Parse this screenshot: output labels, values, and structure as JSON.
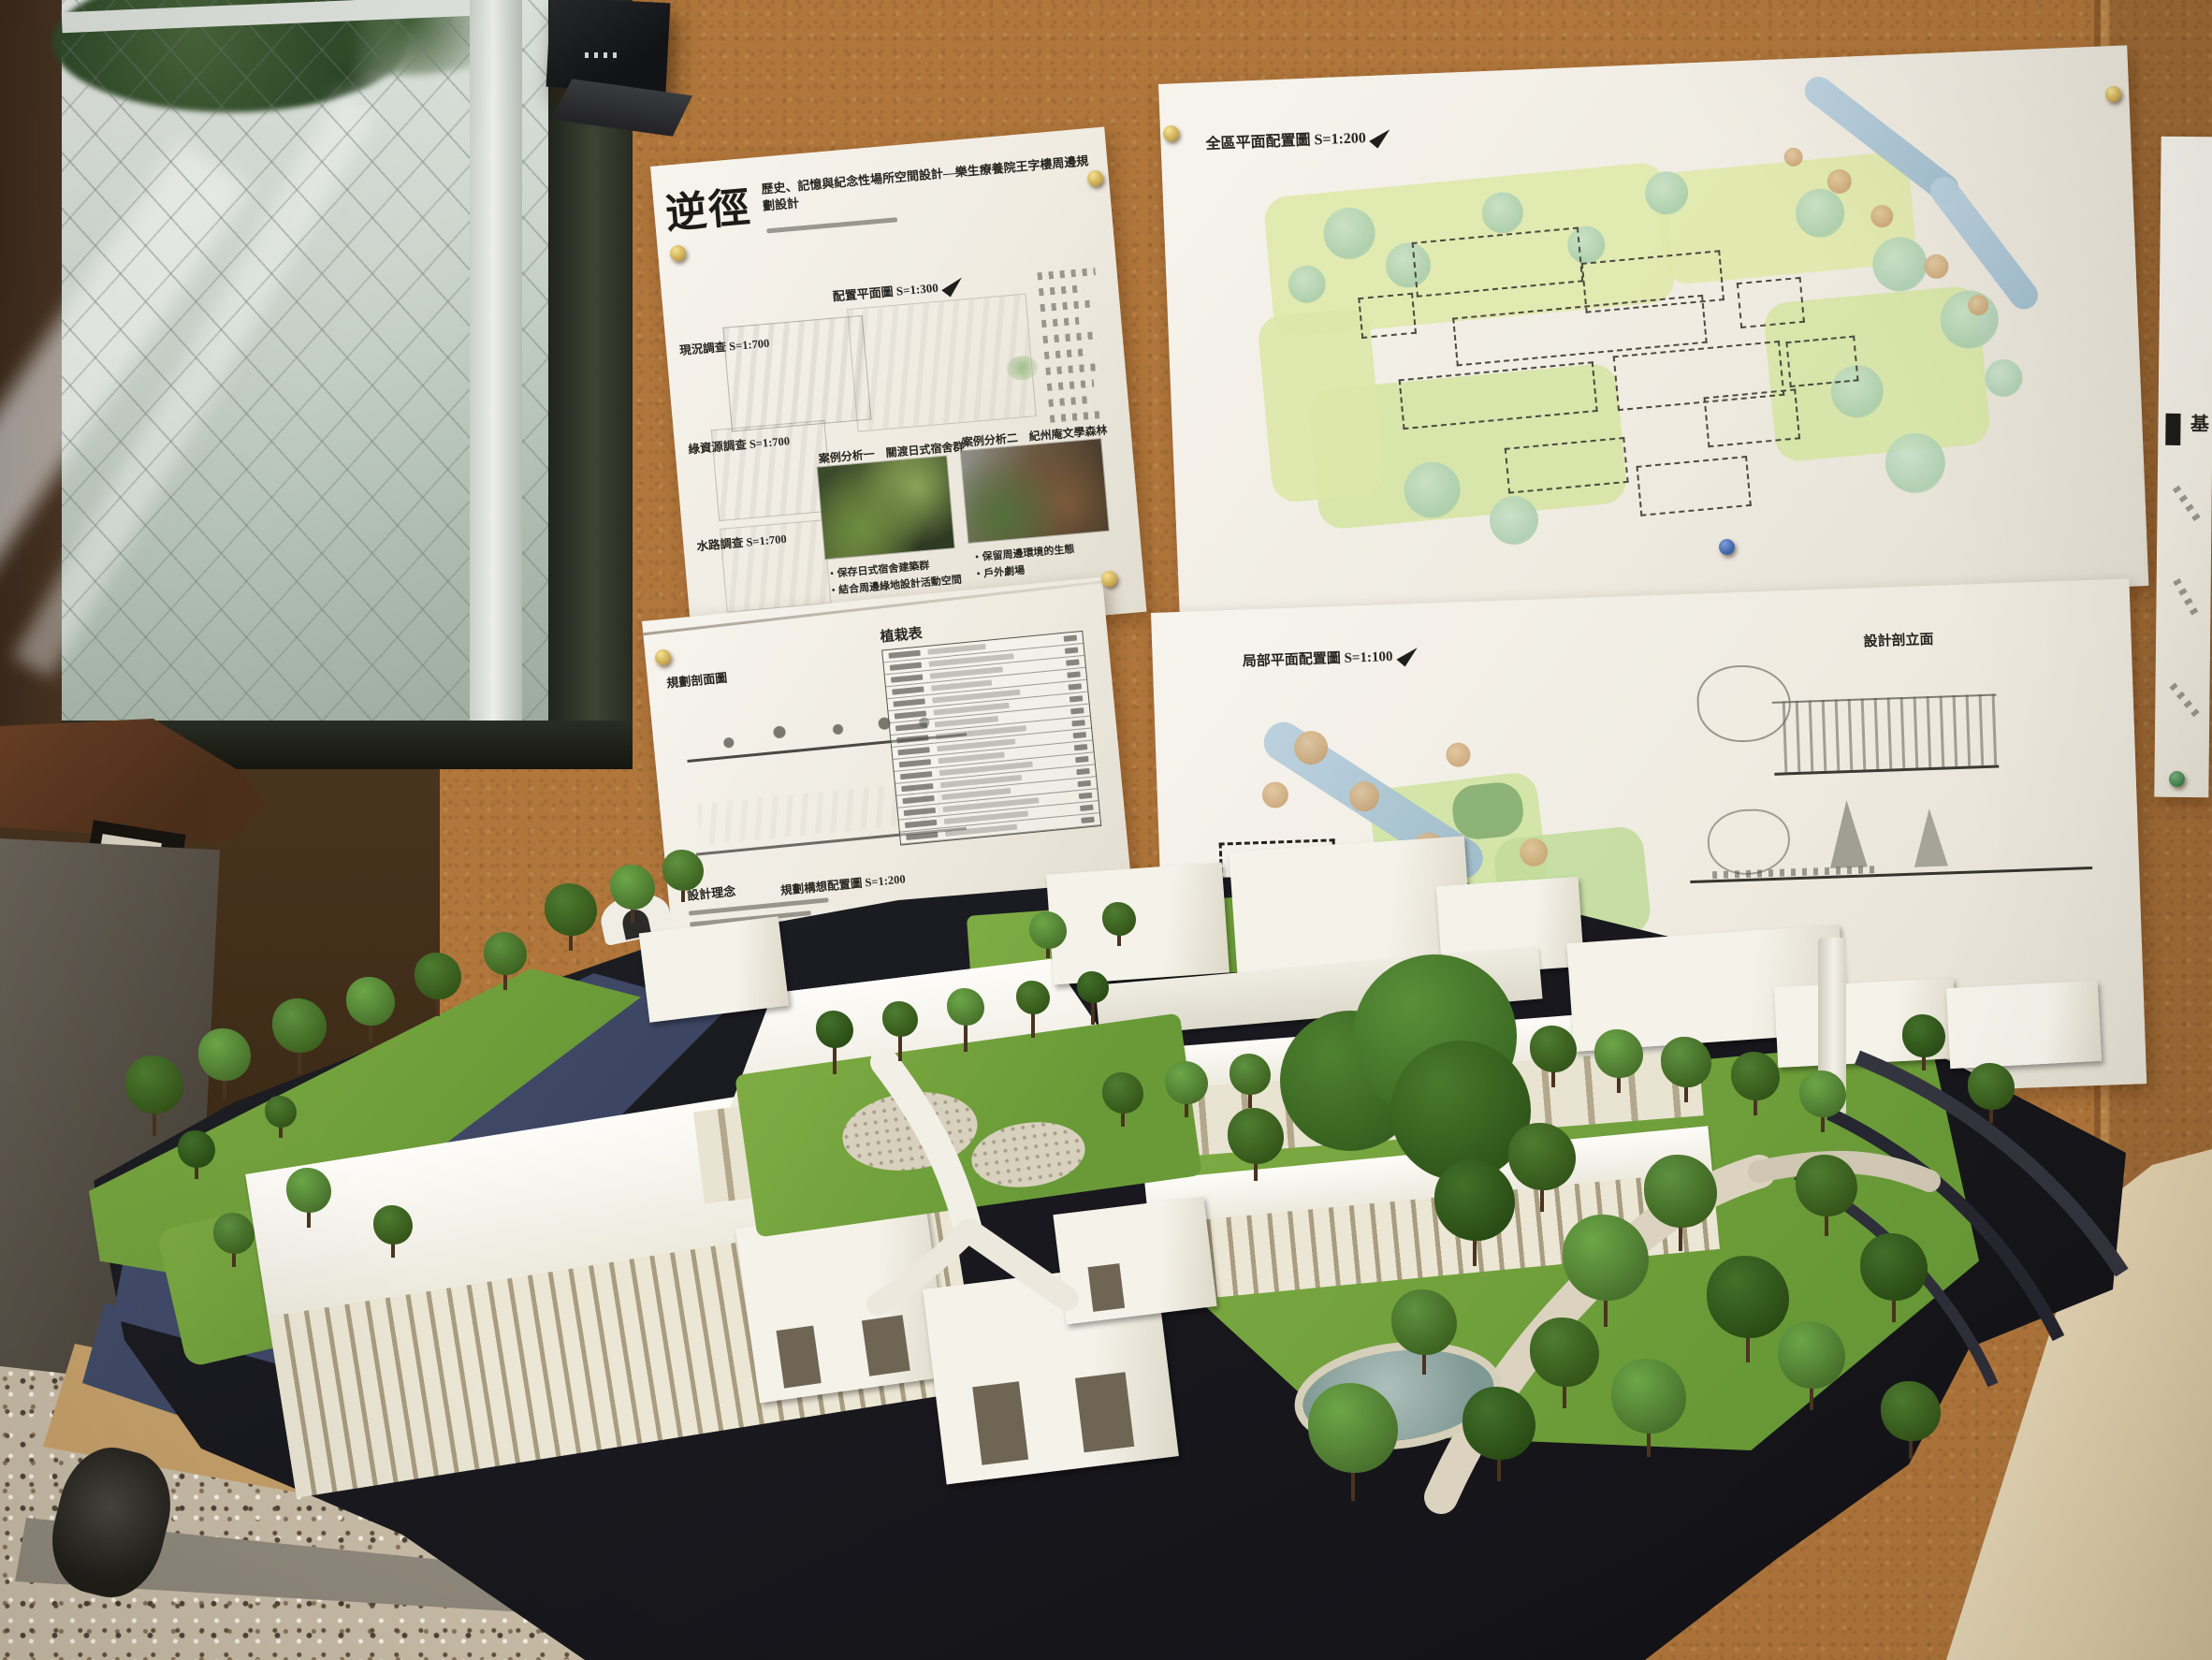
{
  "palette": {
    "cork_wall": "#b1773c",
    "poster_paper": "#f3f0e8",
    "window_frame": "#2e332b",
    "dark_wall": "#43301f",
    "model_base": "#1b1b20",
    "ground_navy": "#3f4a68",
    "lawn_green": "#76a33e",
    "tree_green": "#4e7c2f",
    "building_white": "#f2efe6",
    "wood_rail": "#c7a06a",
    "floor_terrazzo": "#c9bca8",
    "side_table": "#e6d9bf",
    "metal_frame": "#a59e92"
  },
  "posters": {
    "left_top": {
      "logo": "逆徑",
      "title": "歷史、記憶與紀念性場所空間設計—樂生療養院王字樓周邊規劃設計",
      "config_plan_label": "配置平面圖 S=1:300",
      "survey_labels": [
        "現況調查 S=1:700",
        "綠資源調查 S=1:700",
        "水路調查 S=1:700"
      ],
      "case_one_title": "案例分析一　關渡日式宿舍群",
      "case_two_title": "案例分析二　紀州庵文學森林",
      "case_one_bullets": [
        "・保存日式宿舍建築群",
        "・結合周邊綠地設計活動空間"
      ],
      "case_two_bullets": [
        "・保留周邊環境的生態",
        "・戶外劇場"
      ]
    },
    "left_bottom": {
      "section_label": "規劃剖面圖",
      "planting_table_title": "植栽表",
      "concept_label": "設計理念",
      "concept_plan_label": "規劃構想配置圖 S=1:200"
    },
    "right_top": {
      "title": "全區平面配置圖 S=1:200"
    },
    "right_bottom": {
      "plan_label": "局部平面配置圖 S=1:100",
      "elevation_label": "設計剖立面"
    },
    "far_right": {
      "fragment": "基"
    }
  }
}
